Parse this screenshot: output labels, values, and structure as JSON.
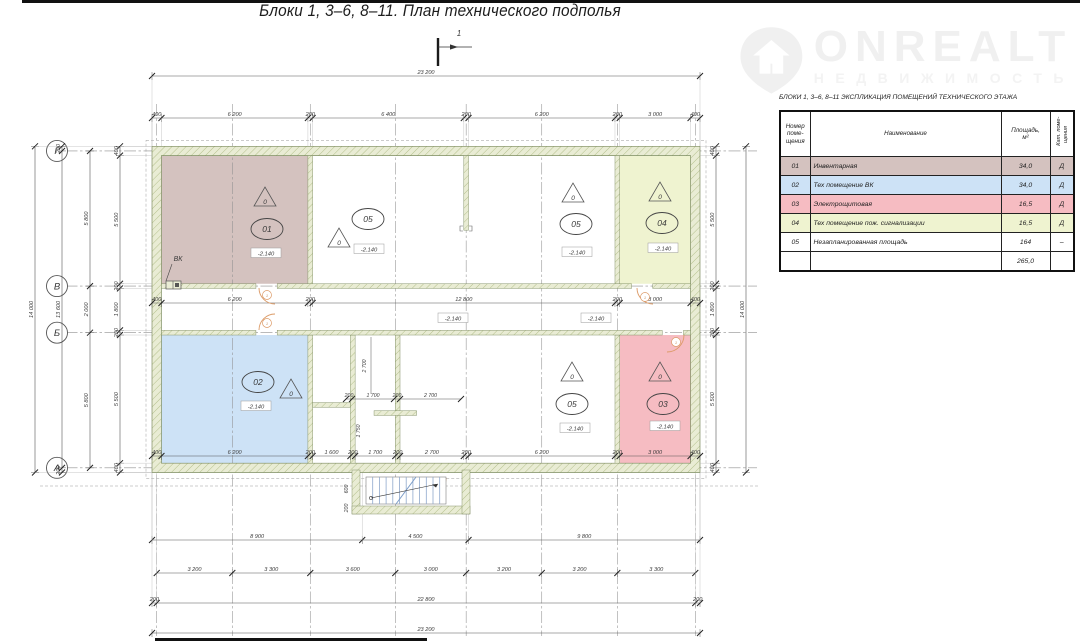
{
  "title": "Блоки 1,  3–6, 8–11.    План технического подполья",
  "watermark": {
    "brand": "ONREALT",
    "subtitle": "НЕДВИЖИМОСТЬ"
  },
  "legend": {
    "title": "БЛОКИ 1,  3–6, 8–11   ЭКСПЛИКАЦИЯ ПОМЕЩЕНИЙ ТЕХНИЧЕСКОГО ЭТАЖА",
    "col_num_lines": [
      "Номер",
      "поме-",
      "щения"
    ],
    "col_name": "Наименование",
    "col_area_lines": [
      "Площадь,",
      "м²"
    ],
    "col_cat_lines": [
      "Кат. поме-",
      "щения"
    ],
    "rows": [
      {
        "num": "01",
        "name": "Инвентарная",
        "area": "34,0",
        "cat": "Д",
        "color": "#d4c2bf"
      },
      {
        "num": "02",
        "name": "Тех помещение ВК",
        "area": "34,0",
        "cat": "Д",
        "color": "#cde2f6"
      },
      {
        "num": "03",
        "name": "Электрощитовая",
        "area": "16,5",
        "cat": "Д",
        "color": "#f6bcc2"
      },
      {
        "num": "04",
        "name": "Тех помещение пож. сигнализации",
        "area": "16,5",
        "cat": "Д",
        "color": "#eff3d0"
      },
      {
        "num": "05",
        "name": "Незапланированная площадь",
        "area": "164",
        "cat": "–",
        "color": "#ffffff"
      }
    ],
    "total_area": "265,0"
  },
  "plan": {
    "axis_bubbles": [
      "Г",
      "В",
      "Б",
      "А"
    ],
    "elevation_mark": "-2.140",
    "triangle_label": "0",
    "vk_label": "ВК",
    "section_label": "1",
    "dims": {
      "top_overall": [
        "23 200"
      ],
      "top": [
        "400",
        "6 200",
        "200",
        "6 400",
        "200",
        "6 200",
        "200",
        "3 000",
        "400"
      ],
      "mid": [
        "400",
        "6 200",
        "200",
        "12 800",
        "200",
        "3 000",
        "400"
      ],
      "lower_inner": [
        "400",
        "6 200",
        "200",
        "1 600",
        "200",
        "1 700",
        "200",
        "2 700",
        "200",
        "6 200",
        "200",
        "3 000",
        "400"
      ],
      "below1": [
        "8 900",
        "4 500",
        "9 800"
      ],
      "below2": [
        "3 200",
        "3 300",
        "3 600",
        "3 000",
        "3 200",
        "3 200",
        "3 300"
      ],
      "below3": [
        "200",
        "22 800",
        "200"
      ],
      "below4": [
        "23 200"
      ],
      "left1": [
        "14 000"
      ],
      "left2": [
        "200",
        "13 600",
        "200"
      ],
      "left3": [
        "5 800",
        "2 000",
        "5 800"
      ],
      "left4": [
        "400",
        "5 500",
        "200",
        "1 800",
        "200",
        "5 500",
        "400"
      ],
      "right1": [
        "400",
        "5 500",
        "200",
        "1 800",
        "200",
        "5 500",
        "400"
      ],
      "right2": [
        "14 000"
      ],
      "shaft_v": [
        "2 700",
        "1 750"
      ],
      "shaft_h": [
        "200",
        "1 700",
        "200",
        "2 700"
      ],
      "entry": [
        "600",
        "200"
      ]
    }
  }
}
